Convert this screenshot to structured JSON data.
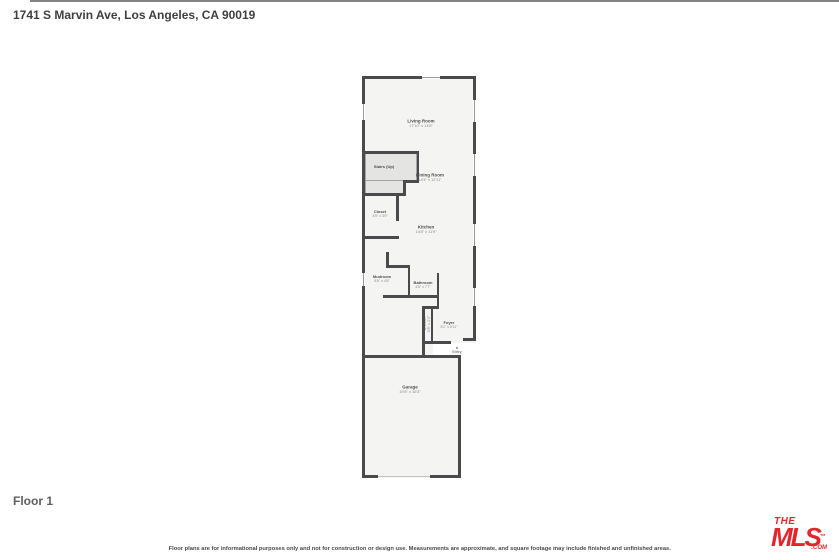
{
  "page": {
    "title": "1741 S Marvin Ave, Los Angeles, CA 90019",
    "floor_label": "Floor 1",
    "footer": "Floor plans are for informational purposes only and not for construction or design use. Measurements are approximate, and square footage may include finished and unfinished areas."
  },
  "floorplan": {
    "rooms": {
      "living_room": {
        "name": "Living Room",
        "dims": "17'10\" x 14'8\""
      },
      "stairs": {
        "name": "Stairs (Up)",
        "dims": ""
      },
      "dining_room": {
        "name": "Dining Room",
        "dims": "14'4\" x 12'11\""
      },
      "closet": {
        "name": "Closet",
        "dims": "4'5\" x 3'9\""
      },
      "kitchen": {
        "name": "Kitchen",
        "dims": "14'8\" x 11'9\""
      },
      "mudroom": {
        "name": "Mudroom",
        "dims": "8'6\" x 4'8\""
      },
      "bathroom": {
        "name": "Bathroom",
        "dims": "4'8\" x 7'7\""
      },
      "hall_closet": {
        "name": "Closet",
        "dims": "5'8\" x 2'4\""
      },
      "foyer": {
        "name": "Foyer",
        "dims": "8'2\" x 5'11\""
      },
      "garage": {
        "name": "Garage",
        "dims": "19'8\" x 16'3\""
      }
    },
    "entry": {
      "label": "Entry",
      "arrow": "▲"
    }
  },
  "logo": {
    "the": "THE",
    "mls": "MLS",
    "tm": "™",
    "com": ".COM"
  },
  "colors": {
    "brand_red": "#e2262c",
    "wall": "#4a4a4c",
    "floor": "#f4f4f3",
    "stairs_fill": "#e4e4e3"
  }
}
